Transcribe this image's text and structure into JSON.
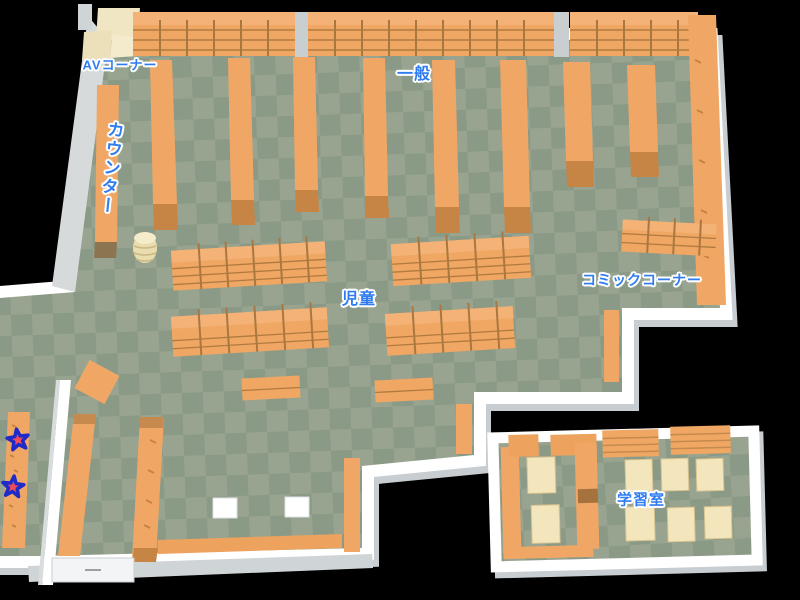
{
  "map": {
    "type": "library-floor-map",
    "background_color": "#000000",
    "floor_colors": {
      "light": "#98a490",
      "dark": "#8a9a86"
    },
    "wall_color": "#ffffff",
    "wall_shadow_color": "#c7cdd0",
    "shelf_color": "#f0a766",
    "shelf_cap_color": "#c28246",
    "table_color": "#f3e6bd",
    "label_color": "#2e7cf0",
    "label_outline_color": "#ffffff"
  },
  "labels": {
    "av_corner": "AVコーナー",
    "counter": "カウンター",
    "general": "一般",
    "children": "児童",
    "comic_corner": "コミックコーナー",
    "study_room": "学習室"
  },
  "markers": {
    "stars": [
      {
        "name": "star-marker-1",
        "x": 18,
        "y": 440,
        "fill": "#ef4b5e",
        "outline": "#1f2bc8"
      },
      {
        "name": "star-marker-2",
        "x": 13,
        "y": 487,
        "fill": "#ef4b5e",
        "outline": "#1f2bc8"
      }
    ]
  }
}
